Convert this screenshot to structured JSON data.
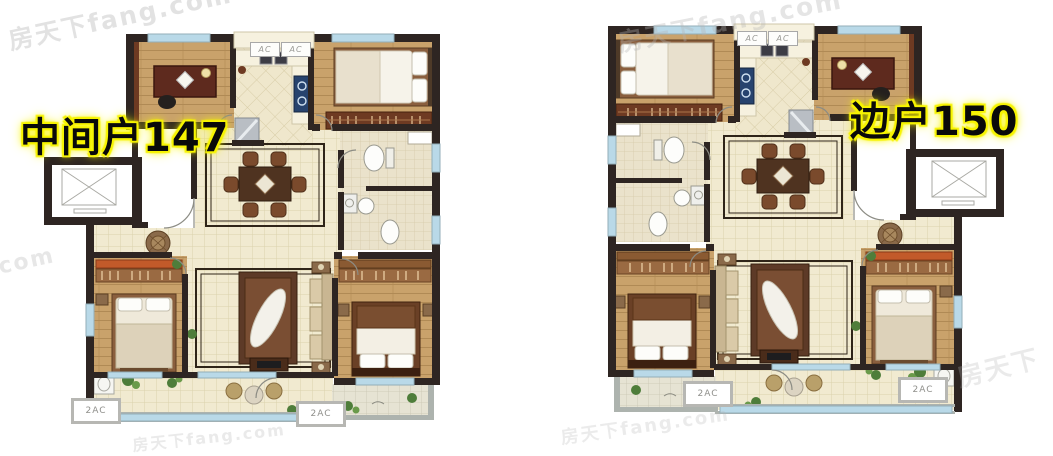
{
  "titles": {
    "left_unit": "中间户147",
    "right_unit": "边户150"
  },
  "ac_labels": {
    "single": "AC",
    "double": "2AC"
  },
  "watermarks": {
    "full": "房天下fang.com",
    "brand": "房天下",
    "fragment": ".com"
  },
  "colors": {
    "wall": "#2e2522",
    "wood": "#c9a26b",
    "tile": "#f1ead0",
    "bath": "#eae2cb",
    "window": "#b9d9e8",
    "window-frame": "#93aeb9",
    "rug": "#5d3a27",
    "furn-red": "#5e2a1e",
    "plant": "#4e7d3a",
    "label-glow": "#f7f400",
    "label-text": "#0a0a0a",
    "watermark": "#b5b5b5"
  }
}
